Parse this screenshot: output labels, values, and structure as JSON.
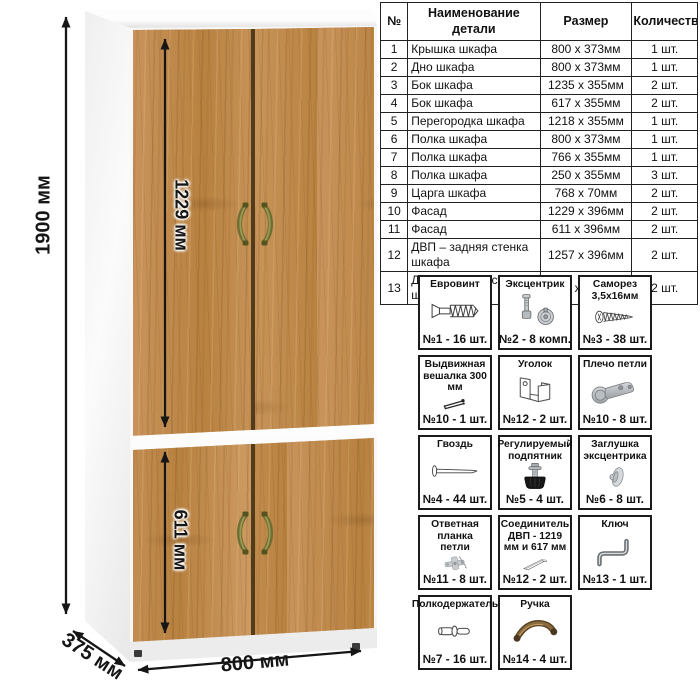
{
  "drawing": {
    "dimensions": {
      "total_height": "1900 мм",
      "upper_door_height": "1229 мм",
      "lower_door_height": "611 мм",
      "width": "800 мм",
      "depth": "375 мм"
    },
    "colors": {
      "wood": "#c28c52",
      "carcass": "#ffffff",
      "handle": "#6e6d33"
    }
  },
  "parts_table": {
    "headers": [
      "№",
      "Наименование детали",
      "Размер",
      "Количество"
    ],
    "rows": [
      {
        "num": "1",
        "name": "Крышка шкафа",
        "size": "800 х 373мм",
        "qty": "1 шт."
      },
      {
        "num": "2",
        "name": "Дно шкафа",
        "size": "800 х 373мм",
        "qty": "1 шт."
      },
      {
        "num": "3",
        "name": "Бок шкафа",
        "size": "1235 х 355мм",
        "qty": "2 шт."
      },
      {
        "num": "4",
        "name": "Бок шкафа",
        "size": "617 х 355мм",
        "qty": "2 шт."
      },
      {
        "num": "5",
        "name": "Перегородка шкафа",
        "size": "1218 х 355мм",
        "qty": "1 шт."
      },
      {
        "num": "6",
        "name": "Полка шкафа",
        "size": "800 х 373мм",
        "qty": "1 шт."
      },
      {
        "num": "7",
        "name": "Полка шкафа",
        "size": "766 х 355мм",
        "qty": "1 шт."
      },
      {
        "num": "8",
        "name": "Полка шкафа",
        "size": "250 х 355мм",
        "qty": "3 шт."
      },
      {
        "num": "9",
        "name": "Царга шкафа",
        "size": "768 х 70мм",
        "qty": "2 шт."
      },
      {
        "num": "10",
        "name": "Фасад",
        "size": "1229 х 396мм",
        "qty": "2 шт."
      },
      {
        "num": "11",
        "name": "Фасад",
        "size": "611 х 396мм",
        "qty": "2 шт."
      },
      {
        "num": "12",
        "name": "ДВП – задняя стенка шкафа",
        "size": "1257 х 396мм",
        "qty": "2 шт."
      },
      {
        "num": "13",
        "name": "ДВП – задняя стенка шкафа",
        "size": "639 х 396мм",
        "qty": "2 шт."
      }
    ]
  },
  "hardware": {
    "items": [
      {
        "name": "Евровинт",
        "count": "№1 - 16 шт.",
        "icon": "euro-screw-icon"
      },
      {
        "name": "Эксцентрик",
        "count": "№2 - 8 комп.",
        "icon": "cam-lock-icon"
      },
      {
        "name": "Саморез 3,5х16мм",
        "count": "№3 - 38 шт.",
        "icon": "tapping-screw-icon"
      },
      {
        "name": "Выдвижная вешалка 300 мм",
        "count": "№10 - 1 шт.",
        "icon": "pullout-hanger-icon"
      },
      {
        "name": "Уголок",
        "count": "№12 - 2 шт.",
        "icon": "corner-bracket-icon"
      },
      {
        "name": "Плечо петли",
        "count": "№10 - 8 шт.",
        "icon": "hinge-arm-icon"
      },
      {
        "name": "Гвоздь",
        "count": "№4 - 44 шт.",
        "icon": "nail-icon"
      },
      {
        "name": "Регулируемый подпятник",
        "count": "№5 - 4 шт.",
        "icon": "adjustable-foot-icon"
      },
      {
        "name": "Заглушка эксцентрика",
        "count": "№6 - 8 шт.",
        "icon": "cam-cap-icon"
      },
      {
        "name": "Ответная планка петли",
        "count": "№11 - 8 шт.",
        "icon": "hinge-plate-icon"
      },
      {
        "name": "Соединитель ДВП - 1219 мм и 617 мм",
        "count": "№12 - 2 шт.",
        "icon": "hdf-connector-icon"
      },
      {
        "name": "Ключ",
        "count": "№13 - 1 шт.",
        "icon": "hex-key-icon"
      },
      {
        "name": "Полкодержатель",
        "count": "№7 - 16 шт.",
        "icon": "shelf-pin-icon"
      },
      {
        "name": "Ручка",
        "count": "№14 - 4 шт.",
        "icon": "handle-icon"
      }
    ]
  }
}
